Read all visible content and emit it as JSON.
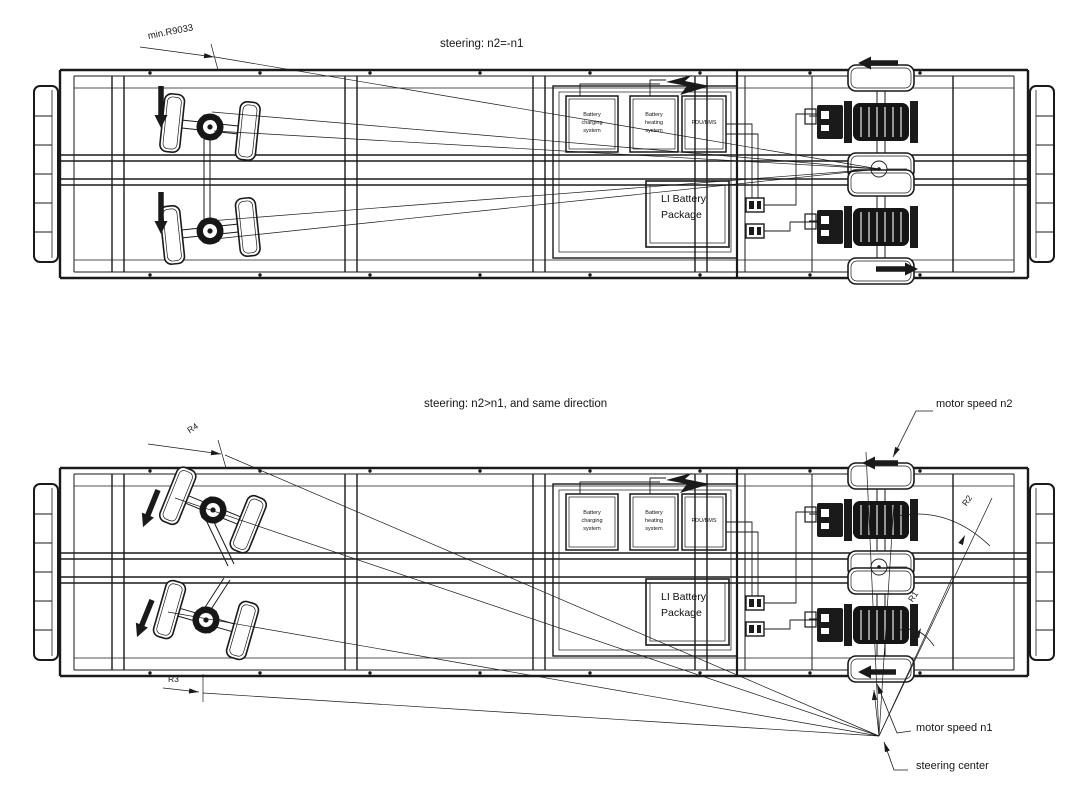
{
  "drawing": {
    "top": {
      "title": "steering: n2=-n1",
      "radius_label": "min.R9033"
    },
    "bottom": {
      "title": "steering: n2>n1, and  same direction",
      "labels": {
        "r1": "R1",
        "r2": "R2",
        "r3": "R3",
        "r4": "R4",
        "motor_speed_n2": "motor speed n2",
        "motor_speed_n1": "motor speed n1",
        "steering_center": "steering center"
      }
    },
    "components": {
      "battery_charging": "Battery charging system",
      "battery_heating": "Battery heating system",
      "pdu_bms": "PDU/BMS",
      "li_battery": "LI Battery Package"
    },
    "colors": {
      "line": "#1a1a1a",
      "background": "#ffffff"
    }
  }
}
